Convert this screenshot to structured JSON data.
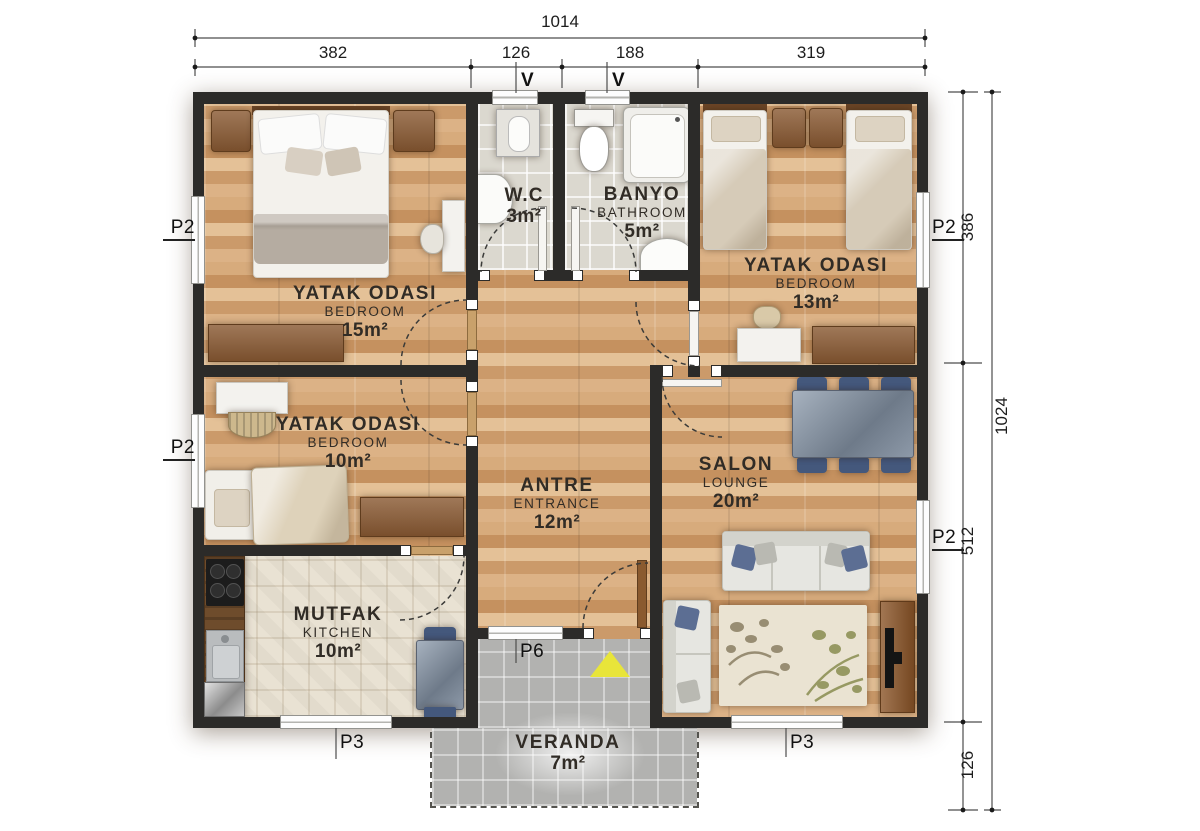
{
  "dimensions": {
    "top_total": "1014",
    "top_segments": [
      "382",
      "126",
      "188",
      "319"
    ],
    "right_segments": [
      "386",
      "512",
      "126"
    ],
    "right_total": "1024"
  },
  "markers": {
    "v_left": "V",
    "v_right": "V",
    "p2_left_top": "P2",
    "p2_left_mid": "P2",
    "p2_right_top": "P2",
    "p2_right_mid": "P2",
    "p3_left": "P3",
    "p3_right": "P3",
    "p6": "P6"
  },
  "rooms": {
    "bedroom15": {
      "name": "YATAK ODASI",
      "name_en": "BEDROOM",
      "area": "15m²"
    },
    "wc": {
      "name": "W.C",
      "area": "3m²"
    },
    "bathroom": {
      "name": "BANYO",
      "name_en": "BATHROOM",
      "area": "5m²"
    },
    "bedroom13": {
      "name": "YATAK ODASI",
      "name_en": "BEDROOM",
      "area": "13m²"
    },
    "bedroom10": {
      "name": "YATAK ODASI",
      "name_en": "BEDROOM",
      "area": "10m²"
    },
    "entrance": {
      "name": "ANTRE",
      "name_en": "ENTRANCE",
      "area": "12m²"
    },
    "lounge": {
      "name": "SALON",
      "name_en": "LOUNGE",
      "area": "20m²"
    },
    "kitchen": {
      "name": "MUTFAK",
      "name_en": "KITCHEN",
      "area": "10m²"
    },
    "veranda": {
      "name": "VERANDA",
      "area": "7m²"
    }
  },
  "colors": {
    "wall": "#2c2b29",
    "wood_floor": "#d2a374",
    "bath_floor": "#dbd8cf",
    "kitchen_floor": "#e9e2d3",
    "veranda_floor": "#b2b2b0",
    "accent_arrow": "#e8e53a",
    "furniture_brown": "#8a5a33",
    "chair_blue": "#44587c"
  }
}
